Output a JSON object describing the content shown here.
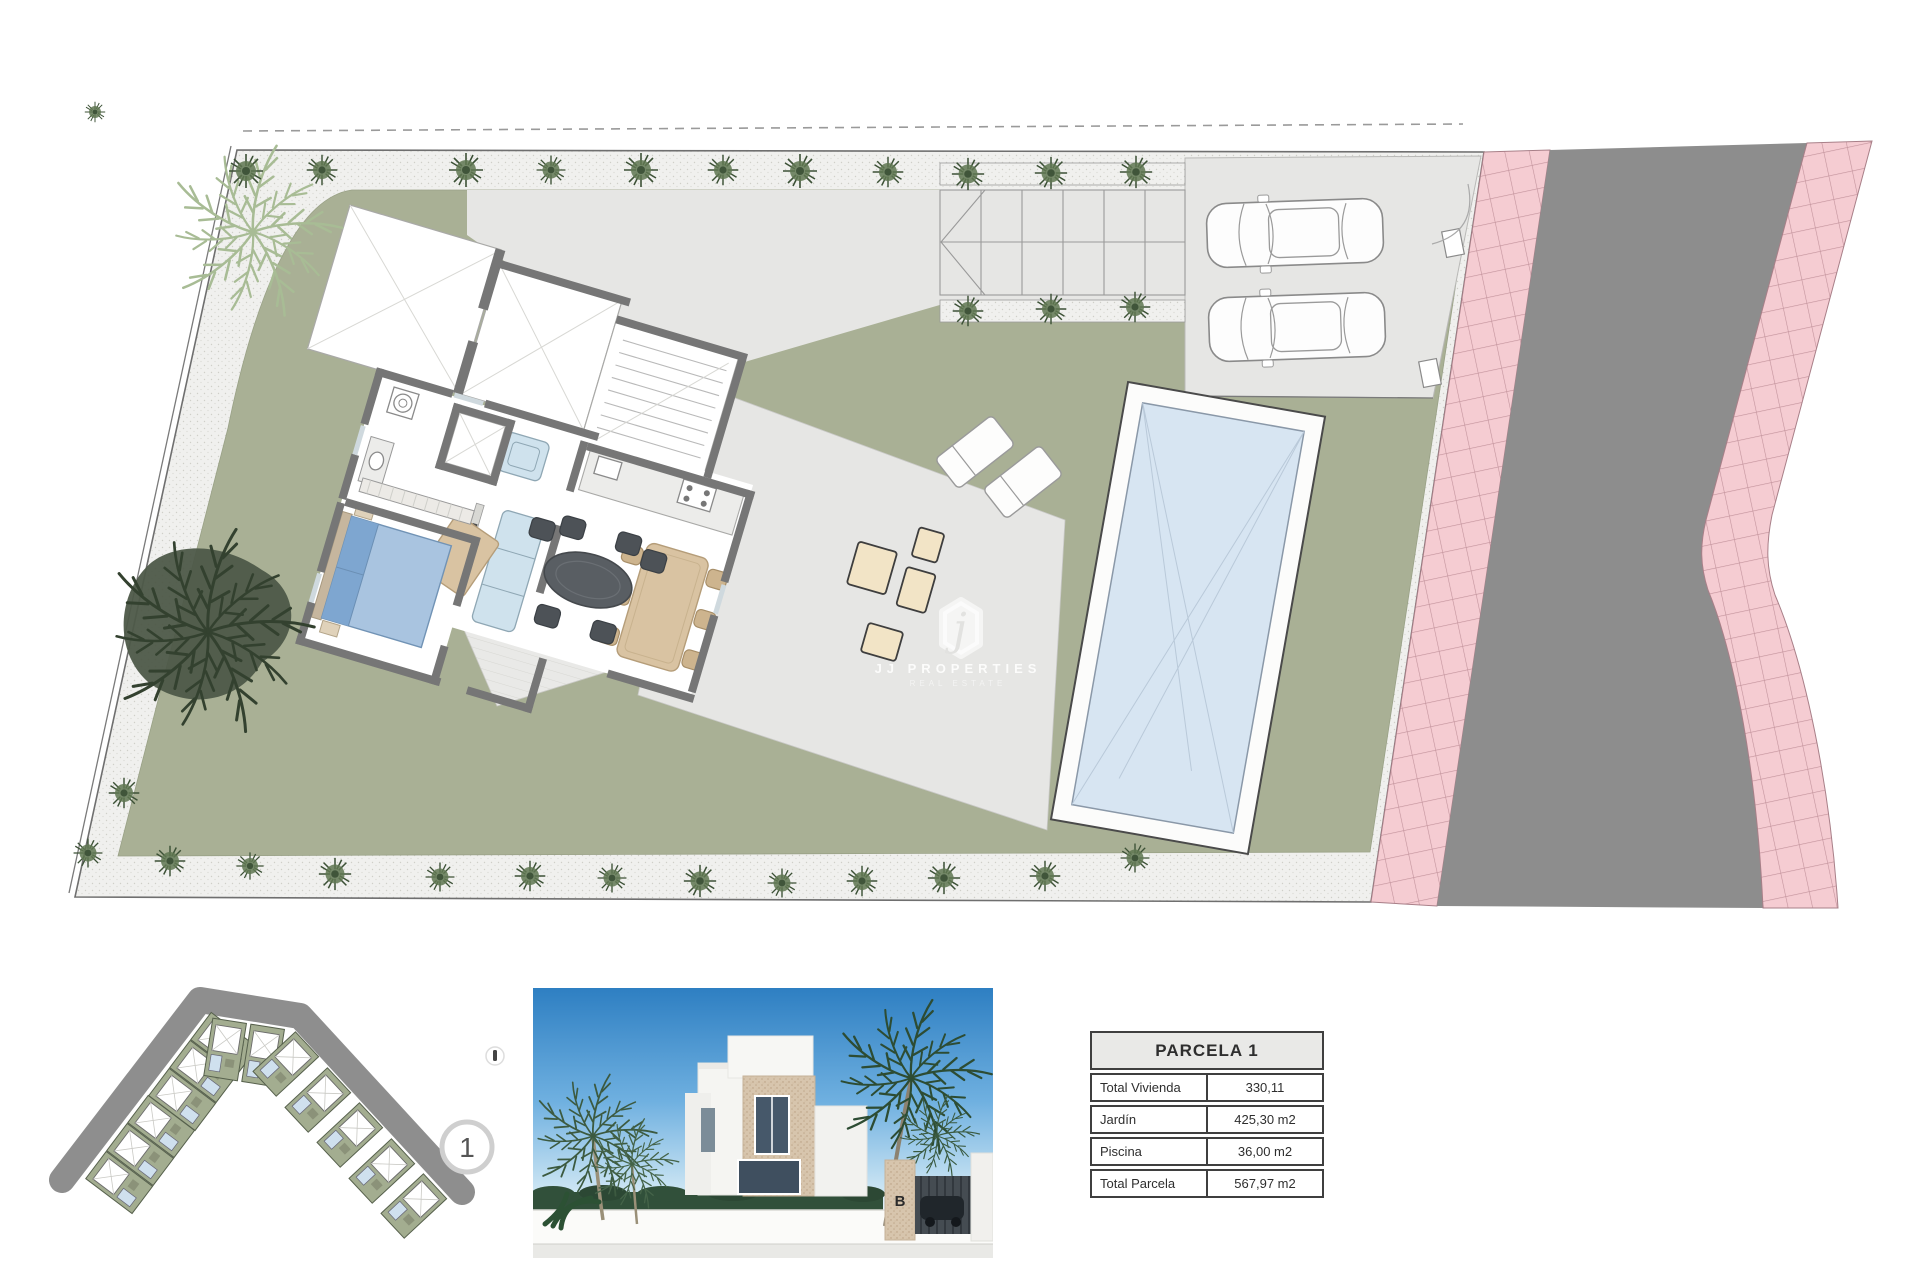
{
  "palette": {
    "lawn": "#a9b095",
    "paving": "#e6e6e4",
    "paving_light": "#ececea",
    "wall": "#767676",
    "pool_water": "#d7e5f2",
    "pool_deck": "#fcfcfb",
    "sidewalk_pink": "#f5ccd2",
    "sidewalk_grid": "#c2929b",
    "road": "#8d8d8d",
    "shrub_dark": "#4d5948",
    "bush": "#5f7751",
    "palm_light": "#a8bc95",
    "palm_dark": "#33412f",
    "bed_blue": "#a9c4e0",
    "sofa_blue": "#cfe2ed",
    "tan": "#d9c3a2",
    "outdoor_dark": "#595e63",
    "cream": "#f2e4c6",
    "sky_top": "#2e7fc2",
    "sky_bottom": "#cfe7f4"
  },
  "watermark": {
    "logo_letter": "j",
    "line1": "JJ PROPERTIES",
    "line2": "REAL ESTATE"
  },
  "location_map": {
    "selected_plot_label": "1"
  },
  "photo": {
    "entrance_letter": "B"
  },
  "table": {
    "title": "PARCELA 1",
    "rows": [
      {
        "label": "Total Vivienda",
        "value": "330,11"
      },
      {
        "label": "Jardín",
        "value": "425,30 m2"
      },
      {
        "label": "Piscina",
        "value": "36,00 m2"
      },
      {
        "label": "Total Parcela",
        "value": "567,97 m2"
      }
    ]
  }
}
